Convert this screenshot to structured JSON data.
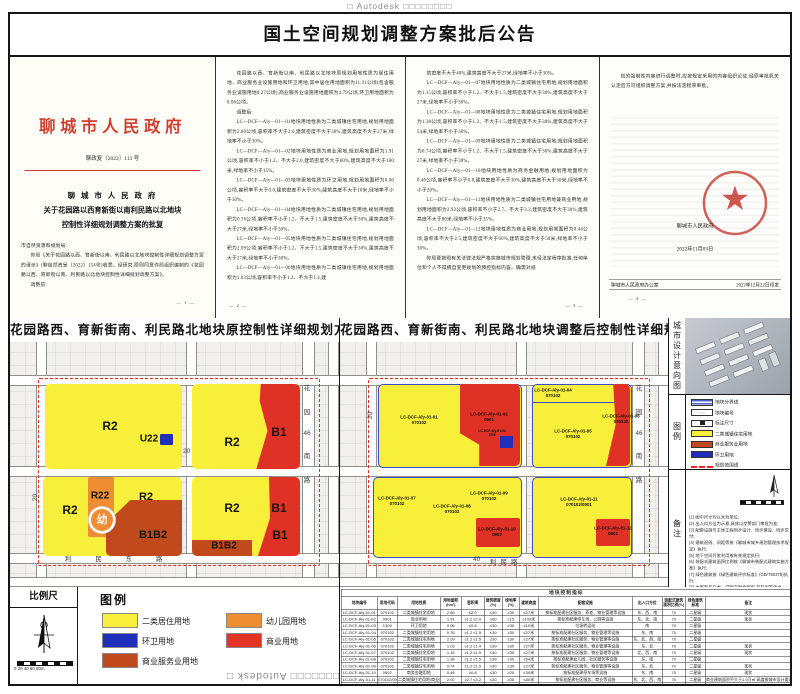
{
  "watermark": {
    "top": "□ Autodesk □□□□□□□□",
    "bottom": "□□□□□□□ Autodesk □"
  },
  "header": {
    "title": "国土空间规划调整方案批后公告"
  },
  "page1": {
    "agency": "聊城市人民政府",
    "doc_no": "聊政复〔2022〕113 号",
    "title_line1": "聊 城 市 人 民 政 府",
    "title_line2": "关于花园路以西育新街以南利民路以北地块",
    "title_line3": "控制性详细规划调整方案的批复",
    "salutation": "市自然资源和规划局:",
    "paragraphs": [
      "你局《关于花园路以西、育新街以南、利民路以北地块控制性详细规划调整方案的请示》(聊自然资呈〔2022〕154号)收悉。经研究,原则同意你局组织编制的《花园路以西、育新街以南、利民路以北地块控制性详细规划调整方案》。",
      "调整前:"
    ],
    "page_no": "— 1 —"
  },
  "page2": {
    "paragraphs": [
      "花园路以西、育新街以南、利民路以北地块原规划用地性质为居住用地、商业服务业设施用地和环卫用地,其中居住用地面积为11.31公顷(包含服务业设施用地0.27公顷),商业服务业设施用地面积为4.79公顷,环卫用地面积为0.06公顷。",
      "调整后:",
      "LC—DCF—Aly—01—01地块用地性质为二类城镇住宅用地,规划用地面积为2.80公顷,容积率不大于2.0,建筑密度不大于30%,建筑高度不大于27米,绿地率不小于30%。",
      "LC—DCF—Aly—01—02地块用地性质为商业用地,规划用地面积为1.91公顷,容积率不小于1.2、不大于2.0,建筑密度不大于60%,建筑高度不大于100米,绿地率不小于15%。",
      "LC—DCF—Aly—01—03地块用地性质为环卫用地,规划用地面积为0.06公顷,容积率不大于0.8,建筑密度不大于30%,建筑高度不大于10米,绿地率不小于30%。",
      "LC—DCF—Aly—01—04地块用地性质为二类城镇住宅用地,规划用地面积为0.76公顷,容积率不小于1.2、不大于1.5,建筑密度不大于30%,建筑高度不大于27米,绿地率不小于30%。",
      "LC—DCF—Aly—01—05地块用地性质为二类城镇住宅用地,规划用地面积为2.09公顷,容积率不小于1.2、不大于1.5,建筑密度不大于30%,建筑高度不大于27米,绿地率不小于30%。",
      "LC—DCF—Aly—01—06地块用地性质为二类城镇住宅用地,规划用地面积为1.03公顷,容积率不小于1.2、不大于1.4,建"
    ],
    "page_no": "— 2 —"
  },
  "page3": {
    "paragraphs": [
      "筑密度不大于40%,建筑高度不大于27米,绿地率不小于30%。",
      "LC—DCF—Aly—01—07地块用地性质为二类城镇住宅用地,规划用地面积为1.15公顷,容积率不小于1.2、不大于1.5,建筑密度不大于30%,建筑高度不大于27米,绿地率不小于30%。",
      "LC—DCF—Aly—01—08地块用地性质为二类城镇住宅用地,规划用地面积为1.38公顷,容积率不小于1.2、不大于1.5,建筑密度不大于30%,建筑高度不大于54米,绿地率不小于30%。",
      "LC—DCF—Aly—01—09地块用地性质为二类城镇住宅用地,规划用地面积为0.74公顷,容积率不小于1.2、不大于1.5,建筑密度不大于30%,建筑高度不大于27米,绿地率不小于30%。",
      "LC—DCF—Aly—01—10地块用地性质为商务金融用地,规划用地面积为0.46公顷,容积率不小于0.8,建筑密度不大于30%,建筑高度不大于30米,绿地率不小于20%。",
      "LC—DCF—Aly—01—11地块用地性质为二类城镇住宅用地兼商业用地,规划用地面积为2.92公顷,容积率不小于2.7、不大于3.2,建筑密度不大于30%,建筑高度不大于80米,绿地率不小于35%。",
      "LC—DCF—Aly—01—12地块用地性质为商业用地,规划用地面积为0.44公顷,容积率不大于2.5,建筑密度不大于60%,建筑高度不大于50米,绿地率不小于30%。",
      "你局要按照有关法律法规严格实施城市规划管理,未经法定程序批准,任何单位和个人不得擅自变更规划的预控指标内容。确需对规"
    ],
    "page_no": "— 3 —"
  },
  "page4": {
    "paragraphs": [
      "划的强制性内容进行调整时,应按规定采用的内容组织论证,经原审批机关认定后方可组织调整方案,并按法定程序审批。"
    ],
    "seal_name": "聊城市人民政府",
    "seal_date": "2022年11月03日",
    "footer_left": "聊城市人民政府办公室",
    "footer_right": "2022年12月22日印发",
    "page_no": "— 4 —"
  },
  "map_left": {
    "title": "花园路西、育新街南、利民路北地块原控制性详细规划方案",
    "zones": [
      "R2",
      "U22",
      "R2",
      "B1",
      "R2",
      "R22",
      "幼",
      "R2",
      "B1B2",
      "R2",
      "B1",
      "B1",
      "B1B2"
    ],
    "roads": {
      "right": [
        "花",
        "园",
        "46",
        "南",
        "路"
      ],
      "bottom": "利 民 东 路",
      "width_mid": "20",
      "width_left": "20"
    }
  },
  "map_right": {
    "title": "花园路西、育新街南、利民路北地块调整后控制性详细规划方案",
    "parcels": [
      {
        "code": "LC-DCF-Aly-01-01",
        "use": "070102"
      },
      {
        "code": "LC-DCF-Aly-01-02",
        "use": "0901"
      },
      {
        "code": "LC-DCF-Aly-01-03",
        "use": "1309"
      },
      {
        "code": "LC-DCF-Aly-01-04",
        "use": "070102"
      },
      {
        "code": "LC-DCF-Aly-01-05",
        "use": "070102"
      },
      {
        "code": "LC-DCF-Aly-01-06",
        "use": "070102"
      },
      {
        "code": "LC-DCF-Aly-01-07",
        "use": "070102"
      },
      {
        "code": "LC-DCF-Aly-01-08",
        "use": "070102"
      },
      {
        "code": "LC-DCF-Aly-01-09",
        "use": "070102"
      },
      {
        "code": "LC-DCF-Aly-01-10",
        "use": "0902"
      },
      {
        "code": "LC-DCF-Aly-01-11",
        "use": "070102/0901"
      },
      {
        "code": "LC-DCF-Aly-01-12",
        "use": "0901"
      }
    ],
    "roads": {
      "right": [
        "花",
        "园",
        "46",
        "南",
        "路"
      ],
      "bottom_name": "利民路",
      "width_left": "20",
      "width_bottom": "40"
    }
  },
  "sidebar": {
    "design_title": "城市设计意向图",
    "legend_title": "图例",
    "legend_items": [
      "地块分界线",
      "地块编号",
      "标注尺寸",
      "二类城镇住宅用地",
      "商业服务业用地",
      "环卫用地",
      "规划范围线"
    ],
    "notes_title": "备注",
    "notes": [
      "(1) 图中尺寸均以米为单位;",
      "(2) 出入口方位为示意,具体以交警部门审批为准;",
      "(3) 配套设施与主体工程同步设计、同步建设、同步交付;",
      "(4) 建筑退线、间距等按《聊城市城乡规划管理技术规定》执行;",
      "(5) 地下空间开发利用按有关规定执行;",
      "(6) 装配式建筑面积比例按《聊城市装配式建筑实施方案》执行;",
      "(7) 绿色建筑按《绿色建筑评价标准》(GB/T50378)执行;",
      "(8) 本图则与文本、说明书配合使用,具有同等效力。"
    ]
  },
  "scalebar": {
    "title": "比例尺",
    "ticks": "0  20  40  60  80m"
  },
  "legend": {
    "title": "图例",
    "items": [
      {
        "label": "二类居住用地",
        "color": "#f8ef3a"
      },
      {
        "label": "环卫用地",
        "color": "#1f2fba"
      },
      {
        "label": "商业服务业用地",
        "color": "#c04a1c"
      },
      {
        "label": "幼儿园用地",
        "color": "#ef8d33"
      },
      {
        "label": "商业用地",
        "color": "#e43425"
      }
    ]
  },
  "table": {
    "title": "地块控制指标",
    "headers": [
      "地块编号",
      "用地代码",
      "用地性质",
      "用地面积(hm²)",
      "容积率",
      "建筑密度(%)",
      "绿地率(%)",
      "建筑高度",
      "配套设施",
      "出入口方位",
      "装配式建筑面积比例(%)",
      "绿色建筑标准",
      "备注"
    ],
    "rows": [
      [
        "LC-DCF-Aly-01-01",
        "070102",
        "二类城镇住宅用地",
        "2.80",
        "≤2.0",
        "≤30",
        "≥30",
        "≤27米",
        "按标准配建社区服务、养老、物业管理等设施",
        "东、西、南",
        "70",
        "二星级",
        "现状"
      ],
      [
        "LC-DCF-Aly-01-02",
        "0901",
        "商业用地",
        "1.91",
        "≥1.2 ≤2.0",
        "≤60",
        "≥15",
        "≤100米",
        "按标准配建停车场、公厕等设施",
        "东、北、南",
        "70",
        "二星级",
        "现状"
      ],
      [
        "LC-DCF-Aly-01-03",
        "1309",
        "环卫用地",
        "0.06",
        "≤0.8",
        "≤30",
        "≥30",
        "≤10米",
        "垃圾转运站",
        "南",
        "70",
        "二星级",
        ""
      ],
      [
        "LC-DCF-Aly-01-04",
        "070102",
        "二类城镇住宅用地",
        "0.76",
        "≥1.2 ≤1.5",
        "≤30",
        "≥30",
        "≤27米",
        "按标准配建社区服务、物业管理等设施",
        "东、南",
        "70",
        "二星级",
        ""
      ],
      [
        "LC-DCF-Aly-01-05",
        "070102",
        "二类城镇住宅用地",
        "2.09",
        "≥1.2 ≤1.5",
        "≤30",
        "≥30",
        "≤27米",
        "按标准配建社区服务、物业管理等设施",
        "东、北、西、南",
        "70",
        "二星级",
        ""
      ],
      [
        "LC-DCF-Aly-01-06",
        "070102",
        "二类城镇住宅用地",
        "1.03",
        "≥1.2 ≤1.4",
        "≤30",
        "≥30",
        "≤27米",
        "按标准配建社区服务、物业管理等设施",
        "东、北",
        "70",
        "二星级",
        "现状"
      ],
      [
        "LC-DCF-Aly-01-07",
        "070102",
        "二类城镇住宅用地",
        "1.15",
        "≥1.2 ≤1.5",
        "≤30",
        "≥30",
        "≤27米",
        "按标准配建社区服务、物业管理等设施",
        "北、西、南",
        "70",
        "二星级",
        "现状"
      ],
      [
        "LC-DCF-Aly-01-08",
        "070102",
        "二类城镇住宅用地",
        "1.38",
        "≥1.2 ≤1.5",
        "≤30",
        "≥30",
        "≤54米",
        "按标准配建幼儿园、社区服务等设施",
        "东、南",
        "70",
        "二星级",
        ""
      ],
      [
        "LC-DCF-Aly-01-09",
        "070102",
        "二类城镇住宅用地",
        "0.74",
        "≥1.2 ≤1.5",
        "≤30",
        "≥30",
        "≤27米",
        "按标准配建社区服务、物业管理等设施",
        "东、北",
        "70",
        "二星级",
        "现状"
      ],
      [
        "LC-DCF-Aly-01-10",
        "0902",
        "商务金融用地",
        "0.46",
        "≥0.8",
        "≤30",
        "≥20",
        "≤30米",
        "按标准配建停车场等设施",
        "东、南",
        "70",
        "二星级",
        "现状"
      ],
      [
        "LC-DCF-Aly-01-11",
        "070102/0901",
        "二类城镇住宅用地/商业用地",
        "2.92",
        "≥2.7 ≤3.2",
        "≤30",
        "≥35",
        "≤80米",
        "按标准配建社区服务、商业等设施",
        "东、北、西、南",
        "70",
        "二星级",
        "商业建筑面积不大于1.0万㎡,高度按城市设计要求执行"
      ],
      [
        "LC-DCF-Aly-01-12",
        "0901",
        "商业用地",
        "0.44",
        "≤2.5",
        "≤60",
        "≥30",
        "≤50米",
        "按标准配建停车场等设施",
        "东、南",
        "70",
        "二星级",
        "现状"
      ]
    ]
  }
}
